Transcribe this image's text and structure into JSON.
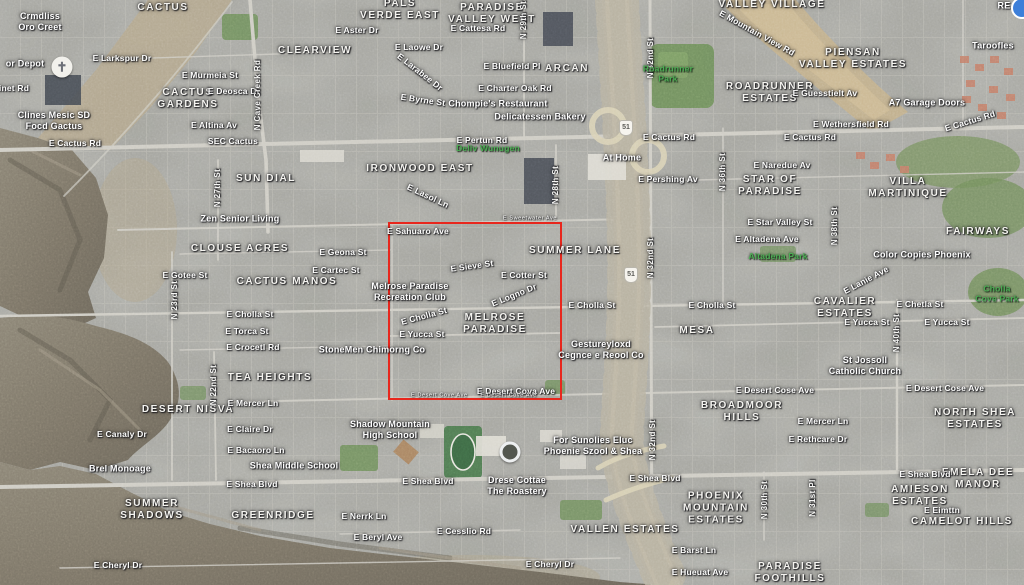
{
  "map": {
    "highlight_box": {
      "x": 388,
      "y": 222,
      "width": 174,
      "height": 178,
      "color": "#e8271d"
    },
    "label_colors": {
      "street": "#fdfdfc",
      "neighborhood": "#f5f4f0",
      "park": "#4cae54",
      "highlight": "#e8271d"
    },
    "labels": [
      {
        "t": "CACTUS",
        "x": 163,
        "y": 8,
        "c": "nb"
      },
      {
        "t": "PALS\nVERDE EAST",
        "x": 400,
        "y": 10,
        "c": "nb"
      },
      {
        "t": "PARADISE\nVALLEY WEST",
        "x": 492,
        "y": 14,
        "c": "nb"
      },
      {
        "t": "VALLEY VILLAGE",
        "x": 772,
        "y": 5,
        "c": "nb"
      },
      {
        "t": "PIENSAN\nVALLEY ESTATES",
        "x": 853,
        "y": 59,
        "c": "nb"
      },
      {
        "t": "CLEARVIEW",
        "x": 315,
        "y": 51,
        "c": "nb"
      },
      {
        "t": "ARCAN",
        "x": 567,
        "y": 69,
        "c": "nb"
      },
      {
        "t": "CACTUS\nGARDENS",
        "x": 188,
        "y": 99,
        "c": "nb"
      },
      {
        "t": "ROADRUNNER\nESTATES",
        "x": 770,
        "y": 93,
        "c": "nb"
      },
      {
        "t": "SUN DIAL",
        "x": 266,
        "y": 179,
        "c": "nb"
      },
      {
        "t": "IRONWOOD EAST",
        "x": 420,
        "y": 169,
        "c": "nb"
      },
      {
        "t": "STAR OF\nPARADISE",
        "x": 770,
        "y": 186,
        "c": "nb"
      },
      {
        "t": "VILLA\nMARTINIQUE",
        "x": 908,
        "y": 188,
        "c": "nb"
      },
      {
        "t": "FAIRWAYS",
        "x": 978,
        "y": 232,
        "c": "nb"
      },
      {
        "t": "CLOUSE ACRES",
        "x": 240,
        "y": 249,
        "c": "nb"
      },
      {
        "t": "CACTUS MANOS",
        "x": 287,
        "y": 282,
        "c": "nb"
      },
      {
        "t": "SUMMER LANE",
        "x": 575,
        "y": 251,
        "c": "nb"
      },
      {
        "t": "MESA",
        "x": 697,
        "y": 331,
        "c": "nb"
      },
      {
        "t": "CAVALIER\nESTATES",
        "x": 845,
        "y": 308,
        "c": "nb"
      },
      {
        "t": "MELROSE\nPARADISE",
        "x": 495,
        "y": 324,
        "c": "nb"
      },
      {
        "t": "TEA HEIGHTS",
        "x": 270,
        "y": 378,
        "c": "nb"
      },
      {
        "t": "DESERT NISVA",
        "x": 188,
        "y": 410,
        "c": "nb"
      },
      {
        "t": "BROADMOOR\nHILLS",
        "x": 742,
        "y": 412,
        "c": "nb"
      },
      {
        "t": "NORTH SHEA\nESTATES",
        "x": 975,
        "y": 419,
        "c": "nb"
      },
      {
        "t": "SUMMER\nSHADOWS",
        "x": 152,
        "y": 510,
        "c": "nb"
      },
      {
        "t": "GREENRIDGE",
        "x": 273,
        "y": 516,
        "c": "nb"
      },
      {
        "t": "VALLEN ESTATES",
        "x": 625,
        "y": 530,
        "c": "nb"
      },
      {
        "t": "PHOENIX\nMOUNTAIN\nESTATES",
        "x": 716,
        "y": 509,
        "c": "nb"
      },
      {
        "t": "AMIESON\nESTATES",
        "x": 920,
        "y": 496,
        "c": "nb"
      },
      {
        "t": "EMELA DEE\nMANOR",
        "x": 978,
        "y": 479,
        "c": "nb"
      },
      {
        "t": "CAMELOT HILLS",
        "x": 962,
        "y": 522,
        "c": "nb"
      },
      {
        "t": "PARADISE\nFOOTHILLS",
        "x": 790,
        "y": 573,
        "c": "nb"
      },
      {
        "t": "E Cactus Rd",
        "x": 75,
        "y": 143,
        "c": "st"
      },
      {
        "t": "SEC Cactus",
        "x": 233,
        "y": 141,
        "c": "st"
      },
      {
        "t": "E Pertun Rd",
        "x": 482,
        "y": 140,
        "c": "st"
      },
      {
        "t": "E Cactus Rd",
        "x": 669,
        "y": 137,
        "c": "st"
      },
      {
        "t": "E Cactus Rd",
        "x": 810,
        "y": 137,
        "c": "st"
      },
      {
        "t": "E Cactus Rd",
        "x": 970,
        "y": 121,
        "c": "st",
        "r": -17
      },
      {
        "t": "E Larkspur Dr",
        "x": 122,
        "y": 58,
        "c": "st"
      },
      {
        "t": "E Murmeia St",
        "x": 210,
        "y": 75,
        "c": "st"
      },
      {
        "t": "E Deosca Dr",
        "x": 234,
        "y": 91,
        "c": "st"
      },
      {
        "t": "E Altina Av",
        "x": 214,
        "y": 125,
        "c": "st"
      },
      {
        "t": "E Aster Dr",
        "x": 357,
        "y": 30,
        "c": "st"
      },
      {
        "t": "E Cattesa Rd",
        "x": 478,
        "y": 28,
        "c": "st"
      },
      {
        "t": "E Laowe Dr",
        "x": 419,
        "y": 47,
        "c": "st"
      },
      {
        "t": "E Larabee Dr",
        "x": 420,
        "y": 72,
        "c": "st",
        "r": 38
      },
      {
        "t": "E Byrne St",
        "x": 423,
        "y": 100,
        "c": "st",
        "r": 8
      },
      {
        "t": "E Bluefield Pl",
        "x": 512,
        "y": 66,
        "c": "st"
      },
      {
        "t": "E Charter Oak Rd",
        "x": 515,
        "y": 88,
        "c": "st"
      },
      {
        "t": "E Wethersfield Rd",
        "x": 851,
        "y": 124,
        "c": "st"
      },
      {
        "t": "E Mountain View Rd",
        "x": 757,
        "y": 33,
        "c": "st",
        "r": 29
      },
      {
        "t": "E Guesstielt Av",
        "x": 825,
        "y": 93,
        "c": "st"
      },
      {
        "t": "E Naredue Av",
        "x": 782,
        "y": 165,
        "c": "st"
      },
      {
        "t": "E Pershing Av",
        "x": 668,
        "y": 179,
        "c": "st"
      },
      {
        "t": "E Star Valley St",
        "x": 780,
        "y": 222,
        "c": "st"
      },
      {
        "t": "E Altadena Ave",
        "x": 767,
        "y": 239,
        "c": "st"
      },
      {
        "t": "E Lanie Ave",
        "x": 866,
        "y": 280,
        "c": "st",
        "r": -28
      },
      {
        "t": "E Geona St",
        "x": 343,
        "y": 252,
        "c": "st"
      },
      {
        "t": "E Cartec St",
        "x": 336,
        "y": 270,
        "c": "st"
      },
      {
        "t": "E Gotee St",
        "x": 185,
        "y": 275,
        "c": "st"
      },
      {
        "t": "E Cotter St",
        "x": 524,
        "y": 275,
        "c": "st"
      },
      {
        "t": "E Sieve St",
        "x": 472,
        "y": 266,
        "c": "st",
        "r": -8
      },
      {
        "t": "E Logno Dr",
        "x": 514,
        "y": 295,
        "c": "st",
        "r": -22
      },
      {
        "t": "E Lasol Ln",
        "x": 428,
        "y": 196,
        "c": "st",
        "r": 25
      },
      {
        "t": "E Sahuaro Ave",
        "x": 418,
        "y": 231,
        "c": "st"
      },
      {
        "t": "E Cholla St",
        "x": 250,
        "y": 314,
        "c": "st"
      },
      {
        "t": "E Cholla St",
        "x": 424,
        "y": 316,
        "c": "st",
        "r": -15
      },
      {
        "t": "E Cholla St",
        "x": 592,
        "y": 305,
        "c": "st"
      },
      {
        "t": "E Cholla St",
        "x": 712,
        "y": 305,
        "c": "st"
      },
      {
        "t": "E Chetla St",
        "x": 920,
        "y": 304,
        "c": "st"
      },
      {
        "t": "E Yucca St",
        "x": 422,
        "y": 334,
        "c": "st"
      },
      {
        "t": "E Yucca St",
        "x": 867,
        "y": 322,
        "c": "st"
      },
      {
        "t": "E Yucca St",
        "x": 947,
        "y": 322,
        "c": "st"
      },
      {
        "t": "E Torca St",
        "x": 247,
        "y": 331,
        "c": "st"
      },
      {
        "t": "E Crocetl Rd",
        "x": 253,
        "y": 347,
        "c": "st"
      },
      {
        "t": "E Desert Cova Ave",
        "x": 516,
        "y": 391,
        "c": "st"
      },
      {
        "t": "E Desert Cose Ave",
        "x": 775,
        "y": 390,
        "c": "st"
      },
      {
        "t": "E Desert Cose Ave",
        "x": 945,
        "y": 388,
        "c": "st"
      },
      {
        "t": "E Mercer Ln",
        "x": 253,
        "y": 403,
        "c": "st"
      },
      {
        "t": "E Mercer Ln",
        "x": 823,
        "y": 421,
        "c": "st"
      },
      {
        "t": "E Rethcare Dr",
        "x": 818,
        "y": 439,
        "c": "st"
      },
      {
        "t": "E Claire Dr",
        "x": 250,
        "y": 429,
        "c": "st"
      },
      {
        "t": "E Canaly Dr",
        "x": 122,
        "y": 434,
        "c": "st"
      },
      {
        "t": "E Bacaoro Ln",
        "x": 256,
        "y": 450,
        "c": "st"
      },
      {
        "t": "E Shea Blvd",
        "x": 252,
        "y": 484,
        "c": "st"
      },
      {
        "t": "E Shea Blvd",
        "x": 428,
        "y": 481,
        "c": "st"
      },
      {
        "t": "E Shea Blvd",
        "x": 655,
        "y": 478,
        "c": "st"
      },
      {
        "t": "E Shea Blvd",
        "x": 925,
        "y": 474,
        "c": "st"
      },
      {
        "t": "E Nerrk Ln",
        "x": 364,
        "y": 516,
        "c": "st"
      },
      {
        "t": "E Beryl Ave",
        "x": 378,
        "y": 537,
        "c": "st"
      },
      {
        "t": "E Cesslio Rd",
        "x": 464,
        "y": 531,
        "c": "st"
      },
      {
        "t": "E Cheryl Dr",
        "x": 118,
        "y": 565,
        "c": "st"
      },
      {
        "t": "E Cheryl Dr",
        "x": 550,
        "y": 564,
        "c": "st"
      },
      {
        "t": "E Eimttn",
        "x": 942,
        "y": 510,
        "c": "st"
      },
      {
        "t": "E Barst Ln",
        "x": 694,
        "y": 550,
        "c": "st"
      },
      {
        "t": "E Hueuat Ave",
        "x": 700,
        "y": 572,
        "c": "st"
      },
      {
        "t": "inet Rd",
        "x": 14,
        "y": 88,
        "c": "st"
      },
      {
        "t": "N Cave Creek Rd",
        "x": 258,
        "y": 95,
        "c": "vt",
        "r": -90
      },
      {
        "t": "N 27th St",
        "x": 218,
        "y": 188,
        "c": "vt",
        "r": -90
      },
      {
        "t": "N 23rd St",
        "x": 175,
        "y": 300,
        "c": "vt",
        "r": -90
      },
      {
        "t": "N 22nd St",
        "x": 214,
        "y": 385,
        "c": "vt",
        "r": -90
      },
      {
        "t": "N 29th St",
        "x": 524,
        "y": 20,
        "c": "vt",
        "r": -90
      },
      {
        "t": "N 28th St",
        "x": 556,
        "y": 185,
        "c": "vt",
        "r": -90
      },
      {
        "t": "N 32nd St",
        "x": 651,
        "y": 58,
        "c": "vt",
        "r": -90
      },
      {
        "t": "N 32nd St",
        "x": 651,
        "y": 258,
        "c": "vt",
        "r": -90
      },
      {
        "t": "N 32nd St",
        "x": 653,
        "y": 440,
        "c": "vt",
        "r": -90
      },
      {
        "t": "N 36th St",
        "x": 723,
        "y": 172,
        "c": "vt",
        "r": -90
      },
      {
        "t": "N 38th St",
        "x": 835,
        "y": 226,
        "c": "vt",
        "r": -90
      },
      {
        "t": "N 40th St",
        "x": 897,
        "y": 333,
        "c": "vt",
        "r": -90
      },
      {
        "t": "N 30th St",
        "x": 765,
        "y": 500,
        "c": "vt",
        "r": -90
      },
      {
        "t": "N 31st Pl",
        "x": 813,
        "y": 498,
        "c": "vt",
        "r": -90
      },
      {
        "t": "or Depot",
        "x": 25,
        "y": 64,
        "c": "bz"
      },
      {
        "t": "Crmdliss\nOro Creet",
        "x": 40,
        "y": 22,
        "c": "bz"
      },
      {
        "t": "Clines Mesic SD\nFocd Gactus",
        "x": 54,
        "y": 121,
        "c": "bz"
      },
      {
        "t": "Zen Senior Living",
        "x": 240,
        "y": 219,
        "c": "bz"
      },
      {
        "t": "Chompie's Restaurant",
        "x": 498,
        "y": 104,
        "c": "bz"
      },
      {
        "t": "Delicatessen Bakery",
        "x": 540,
        "y": 117,
        "c": "bz"
      },
      {
        "t": "At Home",
        "x": 622,
        "y": 158,
        "c": "bz"
      },
      {
        "t": "A7 Garage Doors",
        "x": 927,
        "y": 103,
        "c": "bz"
      },
      {
        "t": "Taroofles",
        "x": 993,
        "y": 46,
        "c": "bz"
      },
      {
        "t": "RE",
        "x": 1004,
        "y": 6,
        "c": "bz"
      },
      {
        "t": "Melrose Paradise\nRecreation Club",
        "x": 410,
        "y": 292,
        "c": "bz"
      },
      {
        "t": "StoneMen Chimorng Co",
        "x": 372,
        "y": 350,
        "c": "bz"
      },
      {
        "t": "Gestureyloxd\nCegnce e Reool Co",
        "x": 601,
        "y": 350,
        "c": "bz"
      },
      {
        "t": "St Jossoll\nCatholic Church",
        "x": 865,
        "y": 366,
        "c": "bz"
      },
      {
        "t": "Color Copies Phoenix",
        "x": 922,
        "y": 255,
        "c": "bz"
      },
      {
        "t": "Shadow Mountain\nHigh School",
        "x": 390,
        "y": 430,
        "c": "bz"
      },
      {
        "t": "Shea Middle School",
        "x": 294,
        "y": 466,
        "c": "bz"
      },
      {
        "t": "For Sunolies Eluc\nPhoenie Szool & Shea",
        "x": 593,
        "y": 446,
        "c": "bz"
      },
      {
        "t": "Drese Cottae\nThe Roastery",
        "x": 517,
        "y": 486,
        "c": "bz"
      },
      {
        "t": "Brel Monoage",
        "x": 120,
        "y": 469,
        "c": "bz"
      },
      {
        "t": "Deliv Wunugen",
        "x": 488,
        "y": 148,
        "c": "pk"
      },
      {
        "t": "Roadrunner\nPark",
        "x": 668,
        "y": 74,
        "c": "pk"
      },
      {
        "t": "Altadena Park",
        "x": 778,
        "y": 256,
        "c": "pk"
      },
      {
        "t": "Cholla\nCove Park",
        "x": 997,
        "y": 294,
        "c": "pk"
      },
      {
        "t": "E Sweetwater Ave",
        "x": 530,
        "y": 219,
        "c": "tiny"
      },
      {
        "t": "E Desert Cove Ave      E Desert Cove Ave",
        "x": 474,
        "y": 396,
        "c": "tiny"
      },
      {
        "t": "✝",
        "x": 62,
        "y": 67,
        "c": "poi-church",
        "n": "church-marker"
      },
      {
        "t": "",
        "x": 510,
        "y": 452,
        "c": "poi-ring",
        "n": "roastery-logo-marker"
      },
      {
        "t": "",
        "x": 1022,
        "y": 8,
        "c": "poi-blue",
        "n": "edge-poi-marker"
      },
      {
        "t": "51",
        "x": 631,
        "y": 275,
        "c": "shield",
        "n": "sr51-route-shield"
      },
      {
        "t": "51",
        "x": 626,
        "y": 128,
        "c": "shield",
        "n": "sr51-route-shield"
      }
    ]
  }
}
